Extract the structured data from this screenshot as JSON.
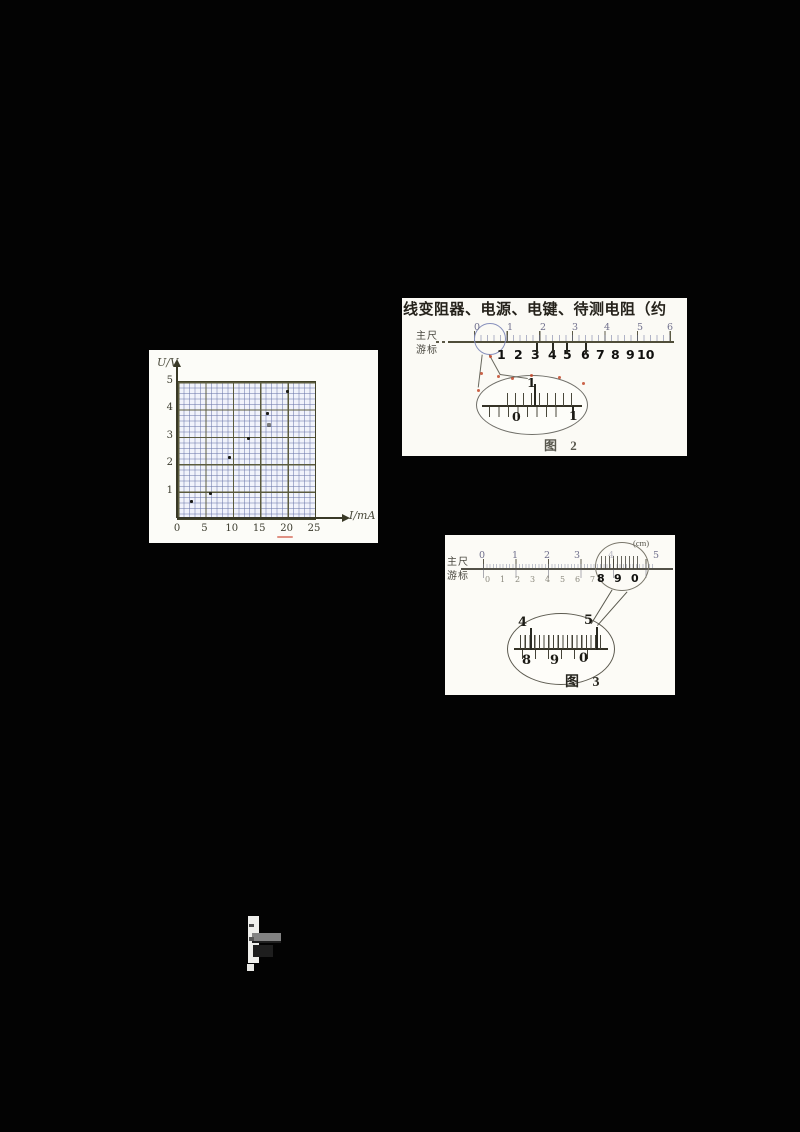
{
  "document": {
    "kind": "scanned physics exam page",
    "background": "#030303",
    "paper_color": "#f6f5f0"
  },
  "text_line": "线变阻器、电源、电键、待测电阻（约",
  "graph": {
    "ylabel": "U/V",
    "xlabel": "I/mA"
  },
  "chart_data": {
    "type": "scatter",
    "title": "",
    "xlabel": "I/mA",
    "ylabel": "U/V",
    "xlim": [
      0,
      25
    ],
    "ylim": [
      0,
      5
    ],
    "x_ticks": [
      "0",
      "5",
      "10",
      "15",
      "20",
      "25"
    ],
    "y_ticks": [
      "1",
      "2",
      "3",
      "4",
      "5"
    ],
    "grid": "fine graph paper; major gridlines every 5 mA and 1 V",
    "legend": "none",
    "points": [
      [
        2.7,
        0.6
      ],
      [
        6.1,
        0.9
      ],
      [
        9.6,
        2.2
      ],
      [
        13.1,
        2.9
      ],
      [
        16.5,
        3.8
      ],
      [
        20.1,
        4.6
      ]
    ],
    "faint_point": [
      16.8,
      3.4
    ]
  },
  "fig2": {
    "ruler_label_top": "主尺",
    "ruler_label_bottom": "游标",
    "main_scale_numbers": [
      "0",
      "1",
      "2",
      "3",
      "4",
      "5",
      "6"
    ],
    "vernier_numbers": [
      "1",
      "2",
      "3",
      "4",
      "5",
      "6",
      "7",
      "8",
      "9",
      "10"
    ],
    "balloon": {
      "top_numbers": [
        "1"
      ],
      "bottom_numbers": [
        "0",
        "1"
      ]
    },
    "caption": "图 2"
  },
  "fig3": {
    "unit": "(cm)",
    "ruler_label_top": "主尺",
    "ruler_label_bottom": "游标",
    "main_scale_numbers": [
      "0",
      "1",
      "2",
      "3",
      "4",
      "5"
    ],
    "vernier_numbers": [
      "0",
      "1",
      "2",
      "3",
      "4",
      "5",
      "6",
      "7",
      "8",
      "9",
      "0"
    ],
    "balloon": {
      "top_numbers": [
        "4",
        "5"
      ],
      "bottom_numbers": [
        "8",
        "9",
        "0"
      ]
    },
    "caption": "图 3"
  },
  "colors": {
    "grid_fine": "#6d78aa",
    "grid_major": "#5c5c40",
    "axis": "#3c3c2a",
    "red_mark": "#bf4a2e",
    "circle_blue": "#8890bb"
  }
}
